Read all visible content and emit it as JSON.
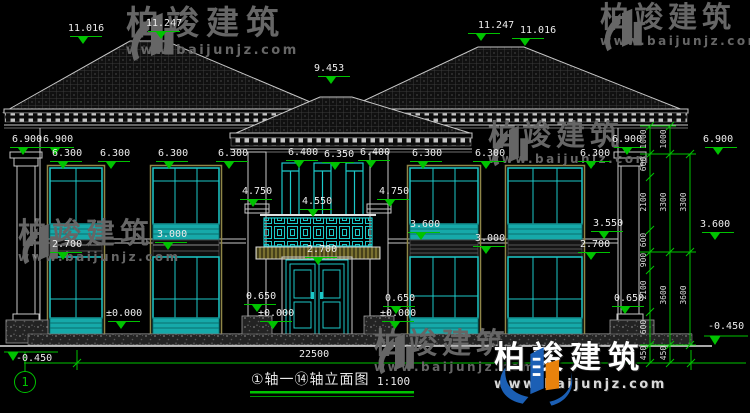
{
  "page": {
    "background": "#000000"
  },
  "title_block": {
    "drawing_title": "①轴一⑭轴立面图",
    "scale": "1:100",
    "axis_bubble": "1"
  },
  "watermark": {
    "brand": "柏竣建筑",
    "url": "www.baijunjz.com"
  },
  "dimensions": {
    "total_width": "22500",
    "chain_inner": [
      "1000",
      "600",
      "2100",
      "600",
      "900",
      "2100",
      "600",
      "450"
    ],
    "chain_middle": [
      "1000",
      "3300",
      "3600",
      "450"
    ],
    "chain_outer": [
      "3300",
      "3600"
    ]
  },
  "elevation_labels": {
    "roof_left_outer": "11.016",
    "roof_left_ridge": "11.247",
    "roof_center": "9.453",
    "roof_right_ridge": "11.247",
    "roof_right_outer": "11.016",
    "eave_left_1": "6.900",
    "eave_left_2": "6.900",
    "eave_right_1": "6.900",
    "eave_right_2": "6.900",
    "win_head_l1": "6.300",
    "win_head_l2": "6.300",
    "win_head_l3": "6.300",
    "win_head_l4": "6.300",
    "porch_head_1": "6.400",
    "porch_head_2": "6.350",
    "porch_head_3": "6.400",
    "win_head_r1": "6.300",
    "win_head_r2": "6.300",
    "win_head_r3": "6.300",
    "balcony_left": "4.750",
    "balcony_center": "4.550",
    "balcony_right": "4.750",
    "sill_r1": "3.600",
    "sill_r2": "3.550",
    "sill_chain": "3.600",
    "floor_l": "3.000",
    "floor_r": "3.000",
    "lintel_l": "2.700",
    "lintel_beam": "2.700",
    "lintel_r": "2.700",
    "porch_floor_1": "0.650",
    "porch_floor_2": "0.650",
    "porch_floor_3": "0.650",
    "ground_1": "±0.000",
    "ground_2": "±0.000",
    "ground_3": "±0.000",
    "site_left": "-0.450",
    "site_right": "-0.450"
  }
}
